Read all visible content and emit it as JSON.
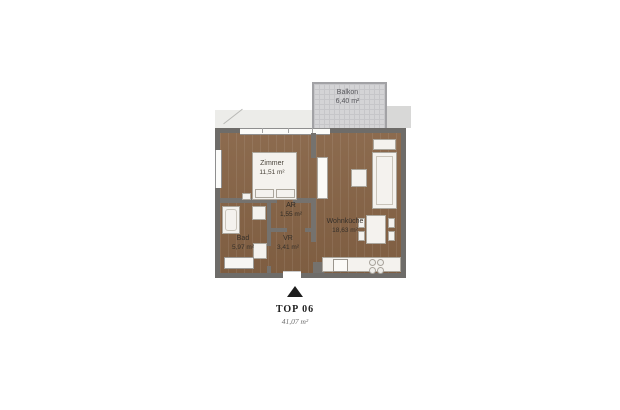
{
  "type": "apartment-floor-plan",
  "balcony": {
    "name": "Balkon",
    "area": "6,40 m²"
  },
  "rooms": [
    {
      "id": "zimmer",
      "name": "Zimmer",
      "area": "11,51 m²"
    },
    {
      "id": "ar",
      "name": "AR",
      "area": "1,55 m²"
    },
    {
      "id": "bad",
      "name": "Bad",
      "area": "5,97 m²"
    },
    {
      "id": "vr",
      "name": "VR",
      "area": "3,41 m²"
    },
    {
      "id": "wohnkueche",
      "name": "Wohnküche",
      "area": "18,63 m²"
    }
  ],
  "unit": {
    "label": "TOP 06",
    "total_area": "41,07 m²"
  },
  "icons": [
    {
      "name": "north-arrow",
      "shape": "triangle-up"
    }
  ],
  "colors": {
    "background": "#ffffff",
    "floor_wood": "#866345",
    "walls": "#6e6c69",
    "balcony_fill": "#d4d4d6",
    "furniture": "#f4f2ee",
    "caption_text": "#1f1f1f"
  }
}
